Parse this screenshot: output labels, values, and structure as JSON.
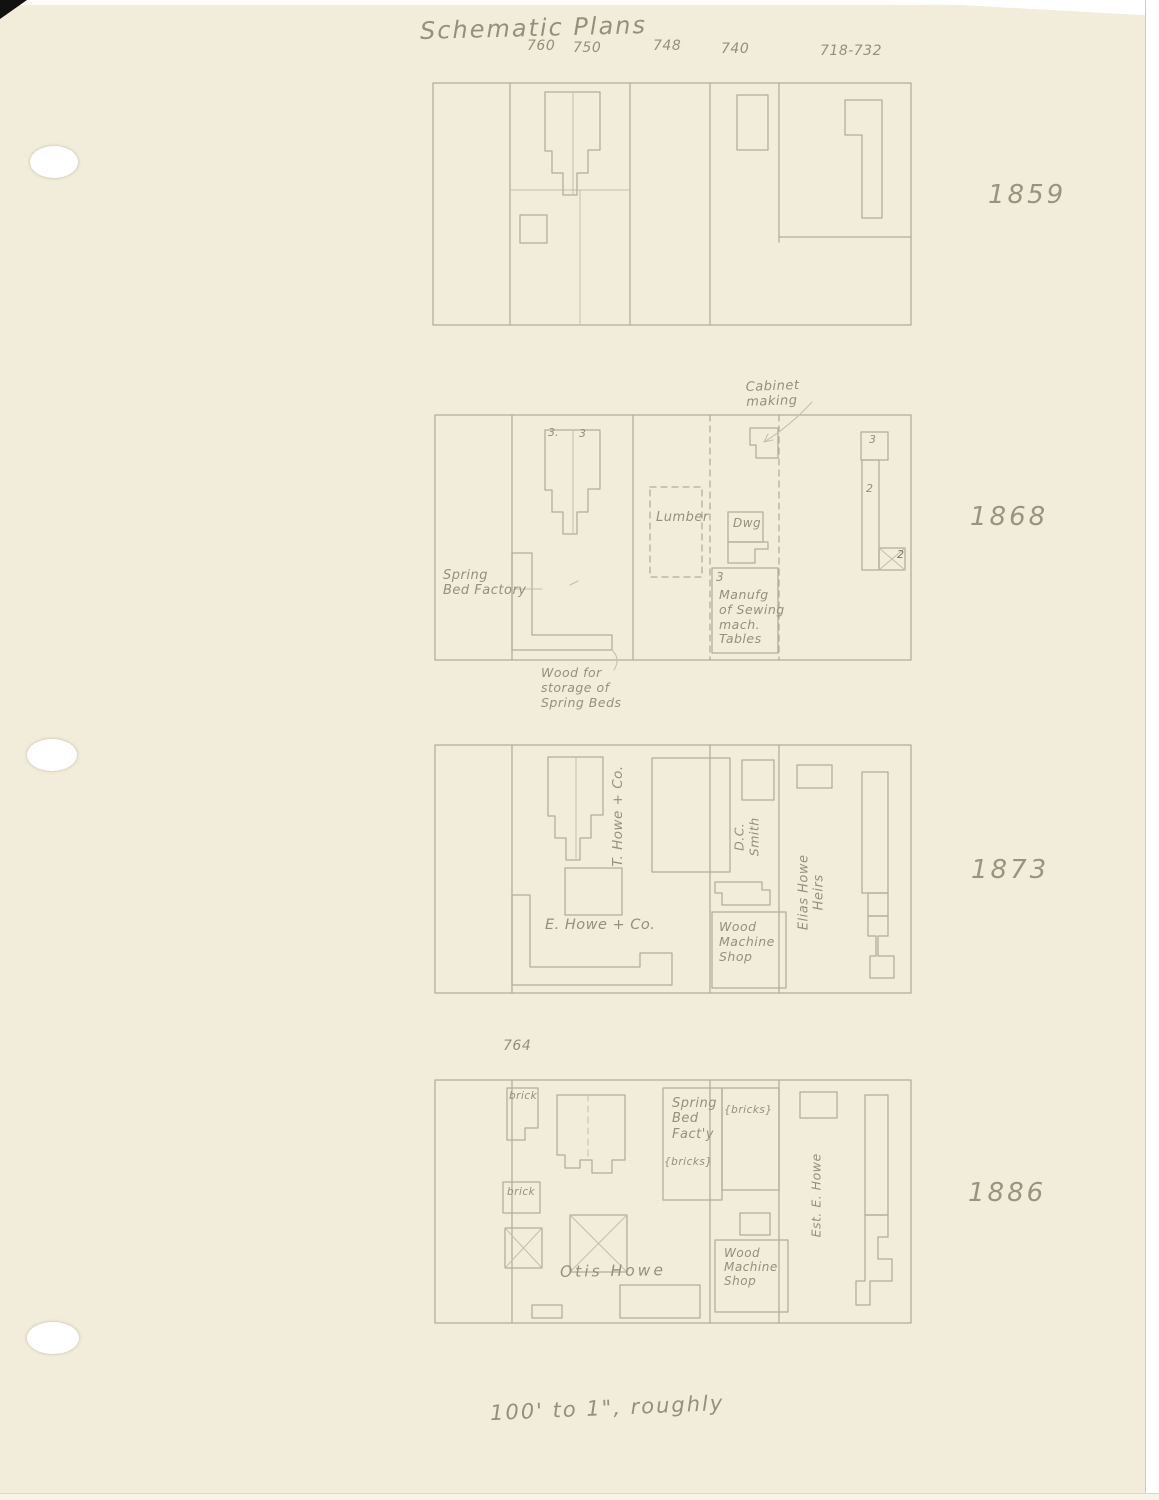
{
  "title": "Schematic Plans",
  "street_numbers": [
    "760",
    "750",
    "748",
    "740",
    "718-732"
  ],
  "scale_note": "100' to 1\", roughly",
  "plans": {
    "y1859": {
      "year": "1859"
    },
    "y1868": {
      "year": "1868",
      "labels": {
        "cabinet_making": "Cabinet\nmaking",
        "bldg_num_3a": "3.",
        "bldg_num_3b": "3",
        "lumber": "Lumber",
        "dwg": "Dwg",
        "manufg_num": "3",
        "manufg": "Manufg\nof Sewing\nmach.\nTables",
        "right_num_3": "3",
        "right_num_2a": "2",
        "right_num_2b": "2",
        "spring_bed_factory": "Spring\nBed Factory",
        "wood_storage": "Wood for\nstorage of\nSpring Beds"
      }
    },
    "y1873": {
      "year": "1873",
      "labels": {
        "t_howe": "T. Howe + Co.",
        "e_howe": "E. Howe + Co.",
        "dc_smith": "D.C.\nSmith",
        "wood_machine_shop": "Wood\nMachine\nShop",
        "elias_howe_heirs": "Elias Howe\nHeirs"
      }
    },
    "y1886": {
      "year": "1886",
      "labels": {
        "address_764": "764",
        "brick_upper": "brick",
        "brick_lower": "brick",
        "spring_bed_facty": "Spring\nBed\nFact'y",
        "bricks_note_a": "{bricks}",
        "bricks_note_b": "{bricks}",
        "otis_howe": "Otis Howe",
        "wood_machine_shop": "Wood\nMachine\nShop",
        "est_e_howe": "Est. E. Howe"
      }
    }
  }
}
